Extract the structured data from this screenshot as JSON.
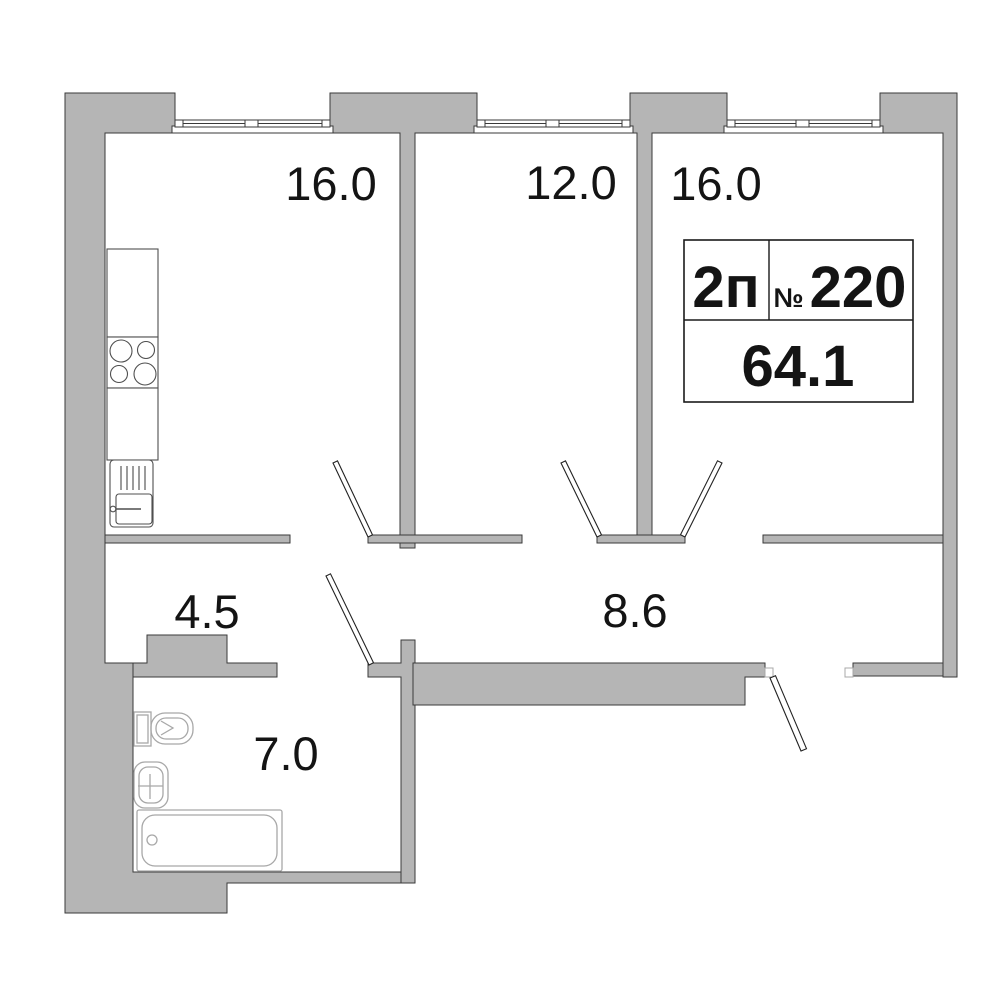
{
  "unit": {
    "type": "2п",
    "number_sign": "№",
    "number": "220",
    "total_area": "64.1"
  },
  "rooms": [
    {
      "id": "kitchen",
      "area": "16.0"
    },
    {
      "id": "bedroom",
      "area": "12.0"
    },
    {
      "id": "living-room",
      "area": "16.0"
    },
    {
      "id": "hallway",
      "area": "4.5"
    },
    {
      "id": "corridor",
      "area": "8.6"
    },
    {
      "id": "bathroom",
      "area": "7.0"
    }
  ],
  "colors": {
    "wall_fill": "#b5b5b5",
    "wall_stroke": "#3a3a3a",
    "door_stroke": "#222222",
    "fixture_light": "#a8a8a8",
    "fixture_dark": "#4f4f4f",
    "label_text": "#141414",
    "box_border": "#1a1a1a"
  }
}
